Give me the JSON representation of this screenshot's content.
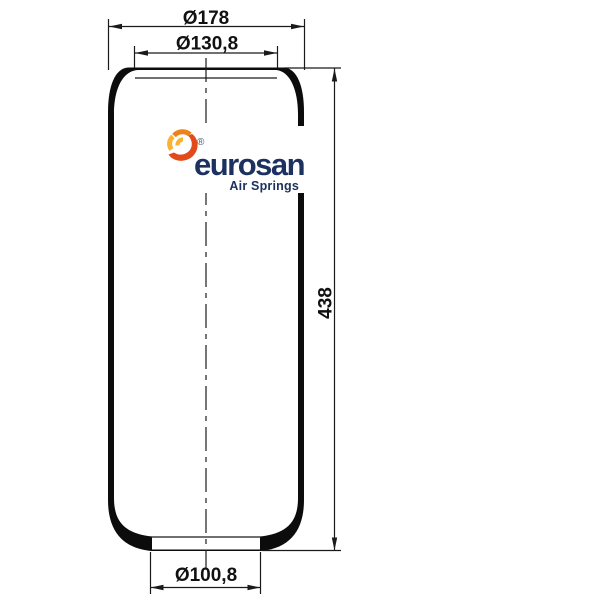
{
  "page": {
    "background": "#ffffff"
  },
  "drawing": {
    "type": "air-spring-cross-section",
    "text_color": "#111111",
    "line_color": "#1a1a1a",
    "dimensions": {
      "top_outer_diameter": "Ø178",
      "top_inner_diameter": "Ø130,8",
      "overall_height": "438",
      "bottom_diameter": "Ø100,8"
    }
  },
  "logo": {
    "icon": "swirl-spark-icon",
    "brand": "eurosan",
    "registered_mark": "®",
    "tagline": "Air Springs",
    "brand_color": "#1d3160",
    "registered_color": "#44546a",
    "icon_colors": {
      "yellow": "#f9b233",
      "orange": "#f08019",
      "red": "#e2491b"
    }
  }
}
